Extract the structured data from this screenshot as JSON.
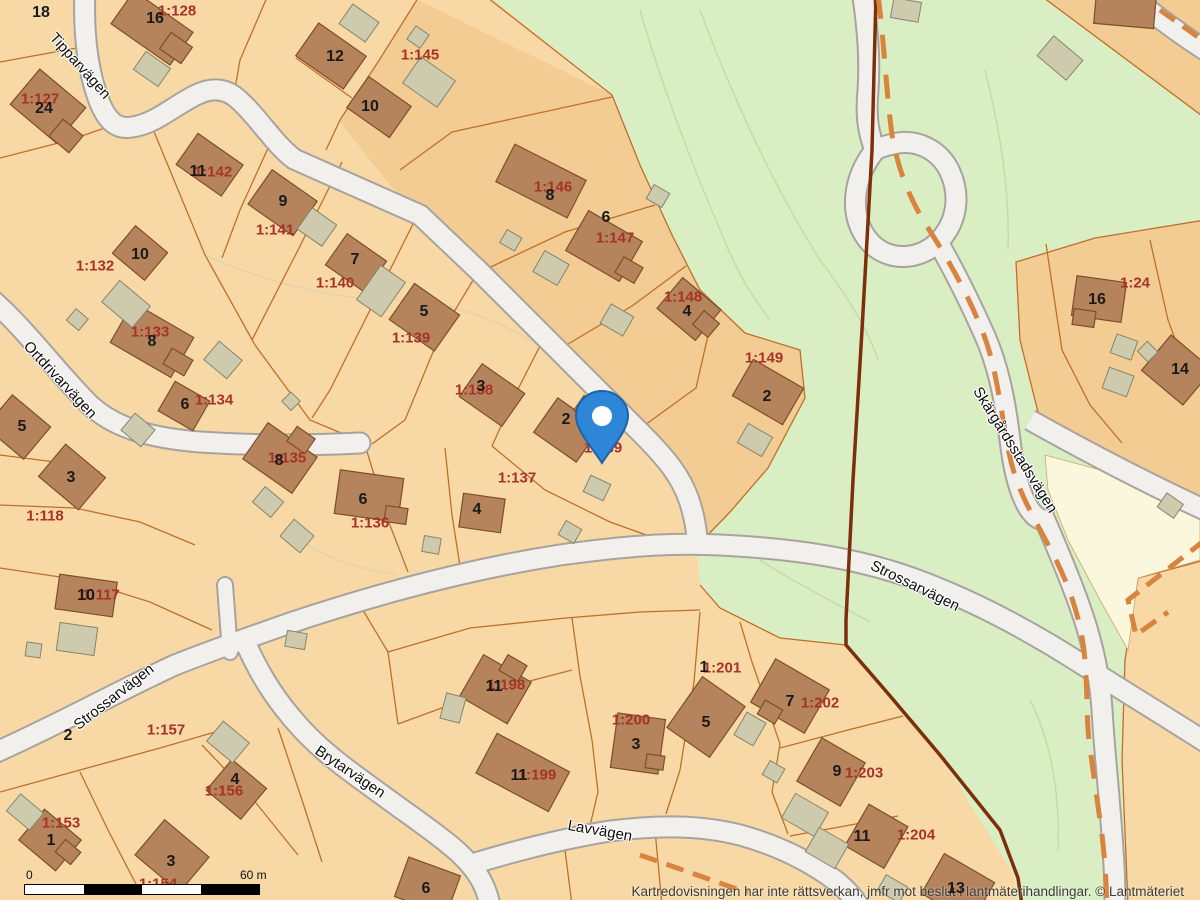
{
  "map_view": {
    "attribution": "Kartredovisningen har inte rättsverkan, jmfr mot beslut i lantmäterihandlingar. © Lantmäteriet",
    "scale_bar": {
      "start": "0",
      "end": "60 m"
    },
    "marker": {
      "name": "location-pin",
      "x": 602,
      "y": 460
    },
    "colors": {
      "parcel_fill": "#f8d9a6",
      "parcel_fill_dark": "#f2cc92",
      "forest_green": "#d9eec3",
      "pale_ground": "#fbf7dd",
      "road_fill": "#f2f0ec",
      "road_edge": "#a8a39d",
      "building": "#b5835c",
      "building_edge": "#7d4f27",
      "outbuilding": "#cecaad",
      "outbuilding_edge": "#85856c",
      "parcel_boundary": "#bf6f2b",
      "boundary_thick": "#7d2e0b",
      "trail_dashed": "#d8833e",
      "parcel_label": "#a73227",
      "house_label": "#1a1a1a",
      "pin_fill": "#2e86d8"
    },
    "streets": [
      {
        "name": "Tipparvägen",
        "x": 80,
        "y": 66,
        "rot": 48
      },
      {
        "name": "Ortdrivarvägen",
        "x": 60,
        "y": 380,
        "rot": 47
      },
      {
        "name": "Strossarvägen",
        "x": 114,
        "y": 697,
        "rot": -38
      },
      {
        "name": "Brytarvägen",
        "x": 350,
        "y": 772,
        "rot": 34
      },
      {
        "name": "Lavvägen",
        "x": 600,
        "y": 831,
        "rot": 10
      },
      {
        "name": "Strossarvägen",
        "x": 915,
        "y": 586,
        "rot": 26
      },
      {
        "name": "Skärgårdsstadsvägen",
        "x": 1015,
        "y": 450,
        "rot": 58
      }
    ],
    "parcels": [
      {
        "id": "1:128",
        "x": 177,
        "y": 11
      },
      {
        "id": "1:145",
        "x": 420,
        "y": 55
      },
      {
        "id": "1:127",
        "x": 40,
        "y": 99
      },
      {
        "id": "1:142",
        "x": 213,
        "y": 172
      },
      {
        "id": "1:146",
        "x": 553,
        "y": 187
      },
      {
        "id": "1:141",
        "x": 275,
        "y": 230
      },
      {
        "id": "1:132",
        "x": 95,
        "y": 266
      },
      {
        "id": "1:147",
        "x": 615,
        "y": 238
      },
      {
        "id": "1:140",
        "x": 335,
        "y": 283
      },
      {
        "id": "1:148",
        "x": 683,
        "y": 297
      },
      {
        "id": "1:24",
        "x": 1135,
        "y": 283
      },
      {
        "id": "1:133",
        "x": 150,
        "y": 332
      },
      {
        "id": "1:139",
        "x": 411,
        "y": 338
      },
      {
        "id": "1:149",
        "x": 764,
        "y": 358
      },
      {
        "id": "1:138",
        "x": 474,
        "y": 390
      },
      {
        "id": "1:134",
        "x": 214,
        "y": 400
      },
      {
        "id": "1:135",
        "x": 287,
        "y": 458
      },
      {
        "id": "1:139",
        "x": 603,
        "y": 448
      },
      {
        "id": "1:137",
        "x": 517,
        "y": 478
      },
      {
        "id": "1:118",
        "x": 45,
        "y": 516
      },
      {
        "id": "1:136",
        "x": 370,
        "y": 523
      },
      {
        "id": "1:117",
        "x": 101,
        "y": 595
      },
      {
        "id": "1:201",
        "x": 722,
        "y": 668
      },
      {
        "id": "1:198",
        "x": 506,
        "y": 685
      },
      {
        "id": "1:202",
        "x": 820,
        "y": 703
      },
      {
        "id": "1:200",
        "x": 631,
        "y": 720
      },
      {
        "id": "1:157",
        "x": 166,
        "y": 730
      },
      {
        "id": "1:203",
        "x": 864,
        "y": 773
      },
      {
        "id": "1:199",
        "x": 537,
        "y": 775
      },
      {
        "id": "1:156",
        "x": 224,
        "y": 791
      },
      {
        "id": "1:153",
        "x": 61,
        "y": 823
      },
      {
        "id": "1:204",
        "x": 916,
        "y": 835
      },
      {
        "id": "1:154",
        "x": 158,
        "y": 884
      }
    ],
    "houses": [
      {
        "no": "18",
        "x": 41,
        "y": 13
      },
      {
        "no": "16",
        "x": 155,
        "y": 19
      },
      {
        "no": "12",
        "x": 335,
        "y": 57
      },
      {
        "no": "10",
        "x": 370,
        "y": 107
      },
      {
        "no": "24",
        "x": 44,
        "y": 109
      },
      {
        "no": "11",
        "x": 198,
        "y": 172
      },
      {
        "no": "8",
        "x": 550,
        "y": 196
      },
      {
        "no": "9",
        "x": 283,
        "y": 202
      },
      {
        "no": "6",
        "x": 606,
        "y": 218
      },
      {
        "no": "10",
        "x": 140,
        "y": 255
      },
      {
        "no": "7",
        "x": 355,
        "y": 260
      },
      {
        "no": "16",
        "x": 1097,
        "y": 300
      },
      {
        "no": "4",
        "x": 687,
        "y": 312
      },
      {
        "no": "5",
        "x": 424,
        "y": 312
      },
      {
        "no": "8",
        "x": 152,
        "y": 342
      },
      {
        "no": "14",
        "x": 1180,
        "y": 370
      },
      {
        "no": "3",
        "x": 481,
        "y": 387
      },
      {
        "no": "2",
        "x": 767,
        "y": 397
      },
      {
        "no": "6",
        "x": 185,
        "y": 405
      },
      {
        "no": "2",
        "x": 566,
        "y": 420
      },
      {
        "no": "5",
        "x": 22,
        "y": 427
      },
      {
        "no": "8",
        "x": 279,
        "y": 461
      },
      {
        "no": "3",
        "x": 71,
        "y": 478
      },
      {
        "no": "6",
        "x": 363,
        "y": 500
      },
      {
        "no": "4",
        "x": 477,
        "y": 510
      },
      {
        "no": "10",
        "x": 86,
        "y": 596
      },
      {
        "no": "1",
        "x": 704,
        "y": 668
      },
      {
        "no": "11",
        "x": 494,
        "y": 687
      },
      {
        "no": "7",
        "x": 790,
        "y": 702
      },
      {
        "no": "5",
        "x": 706,
        "y": 723
      },
      {
        "no": "2",
        "x": 68,
        "y": 736
      },
      {
        "no": "3",
        "x": 636,
        "y": 745
      },
      {
        "no": "9",
        "x": 837,
        "y": 772
      },
      {
        "no": "11",
        "x": 519,
        "y": 776
      },
      {
        "no": "4",
        "x": 235,
        "y": 780
      },
      {
        "no": "11",
        "x": 862,
        "y": 837
      },
      {
        "no": "1",
        "x": 51,
        "y": 841
      },
      {
        "no": "3",
        "x": 171,
        "y": 862
      },
      {
        "no": "6",
        "x": 426,
        "y": 889
      },
      {
        "no": "13",
        "x": 956,
        "y": 889
      }
    ]
  }
}
